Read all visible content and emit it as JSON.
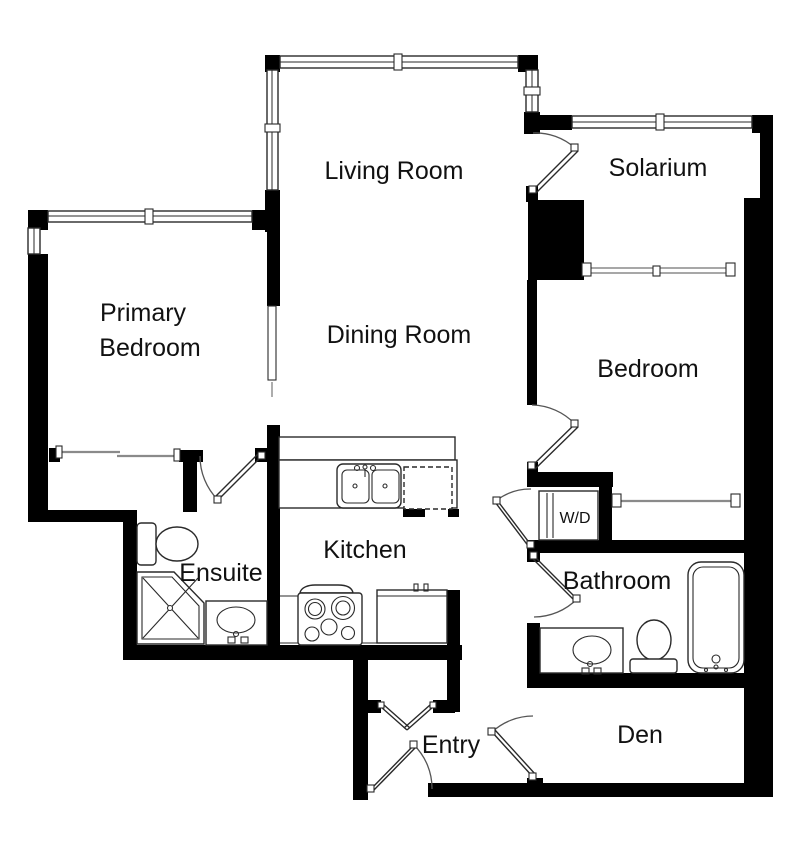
{
  "rooms": {
    "living_room": {
      "label": "Living Room"
    },
    "solarium": {
      "label": "Solarium"
    },
    "primary_bedroom": {
      "label_line1": "Primary",
      "label_line2": "Bedroom"
    },
    "dining_room": {
      "label": "Dining Room"
    },
    "bedroom": {
      "label": "Bedroom"
    },
    "kitchen": {
      "label": "Kitchen"
    },
    "ensuite": {
      "label": "Ensuite"
    },
    "laundry_closet": {
      "label": "W/D"
    },
    "bathroom": {
      "label": "Bathroom"
    },
    "entry": {
      "label": "Entry"
    },
    "den": {
      "label": "Den"
    }
  },
  "colors": {
    "wall": "#000000",
    "fixture_line": "#2a2a2a",
    "window_line": "#8a8a8a",
    "background": "#ffffff",
    "text": "#111111"
  }
}
